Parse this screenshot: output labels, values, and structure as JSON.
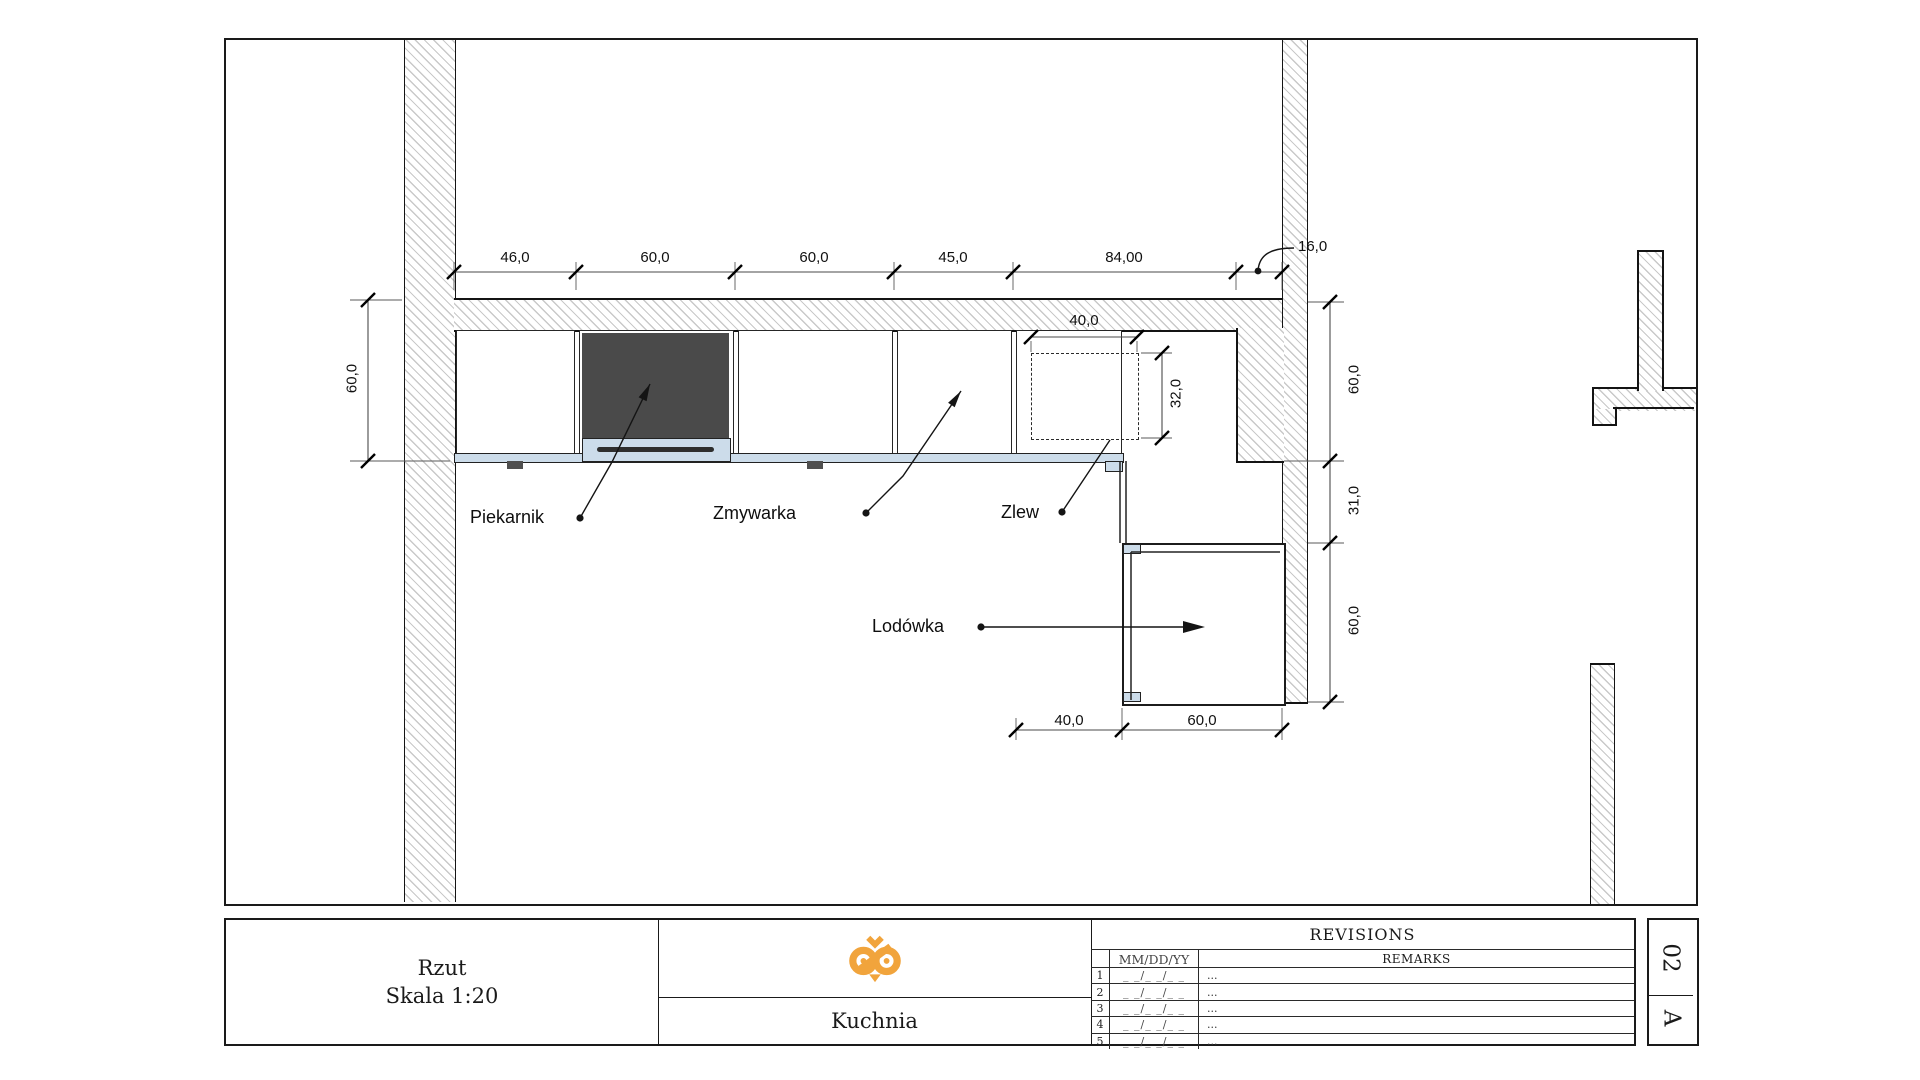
{
  "colors": {
    "line": "#1a1a1a",
    "hatch_line": "#c9c9c9",
    "oven_fill": "#4a4a4a",
    "counter_edge": "#ccdcea",
    "logo_orange": "#F1A43C"
  },
  "plan": {
    "appliance_labels": {
      "oven": "Piekarnik",
      "dishwasher": "Zmywarka",
      "sink": "Zlew",
      "fridge": "Lodówka"
    },
    "dimensions": {
      "top": [
        "46,0",
        "60,0",
        "60,0",
        "45,0",
        "84,00"
      ],
      "wall_niche": "16,0",
      "left_depth": "60,0",
      "sink_width": "40,0",
      "sink_depth": "32,0",
      "right": [
        "60,0",
        "31,0",
        "60,0"
      ],
      "bottom": [
        "40,0",
        "60,0"
      ]
    }
  },
  "title_block": {
    "drawing_title": "Rzut",
    "scale": "Skala 1:20",
    "project_name": "Kuchnia",
    "logo_icon": "owl-logo",
    "sheet_letter": "A",
    "sheet_number": "02",
    "revisions": {
      "title": "REVISIONS",
      "date_header": "MM/DD/YY",
      "remarks_header": "REMARKS",
      "rows": [
        {
          "num": "1",
          "date": "_ _/_ _/_ _",
          "remarks": "..."
        },
        {
          "num": "2",
          "date": "_ _/_ _/_ _",
          "remarks": "..."
        },
        {
          "num": "3",
          "date": "_ _/_ _/_ _",
          "remarks": "..."
        },
        {
          "num": "4",
          "date": "_ _/_ _/_ _",
          "remarks": "..."
        },
        {
          "num": "5",
          "date": "_ _/_ _/_ _",
          "remarks": "..."
        }
      ]
    }
  }
}
